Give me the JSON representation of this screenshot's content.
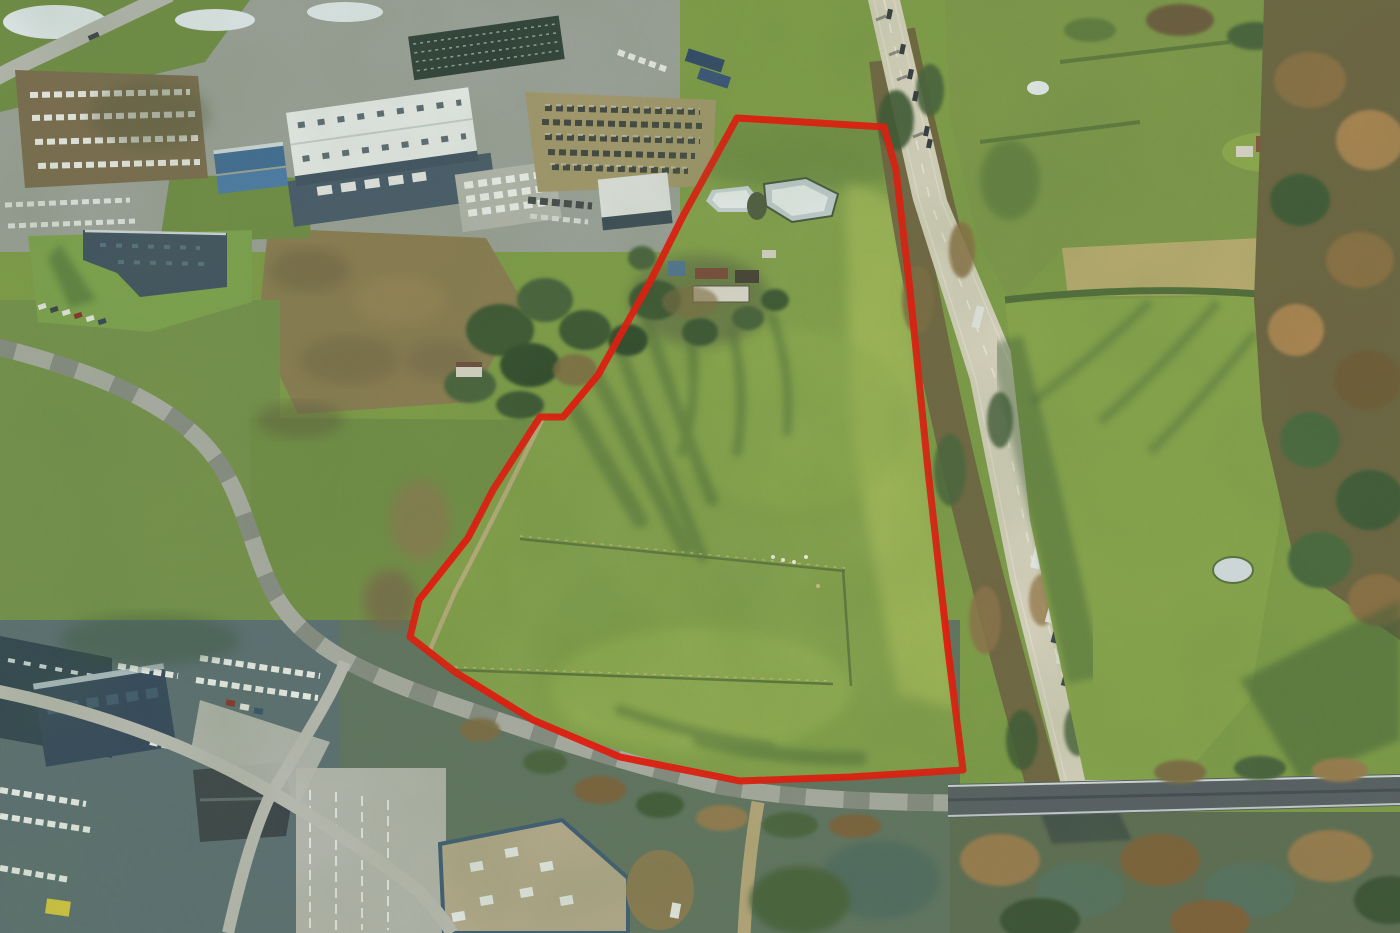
{
  "meta": {
    "type": "aerial-photograph",
    "subject": "winter aerial photo of a development land parcel outlined in red, bounded by a motorway on the east, a local ring road on the south and an industrial estate on the west",
    "contains_text": false
  },
  "annotation": {
    "boundary_color": "#e81408",
    "boundary_stroke_width": 7,
    "boundary_points": "737,118 884,127 896,170 910,290 928,470 948,650 963,770 850,777 740,781 620,757 533,720 455,672 410,637 419,600 468,538 493,490 540,417 563,417 598,375 650,282 683,216"
  },
  "palette": {
    "parcel_grass": "#7e9c46",
    "bright_grass": "#a6bc57",
    "east_field": "#87a44a",
    "motorway": "#d9d3c0",
    "local_road": "#a9aba3",
    "dirt_track": "#b7a67a",
    "scrubland": "#8b7a51",
    "woodland_brown": "#6b6240",
    "tree_green": "#3a5432",
    "roof_white": "#e9eceb",
    "roof_slate": "#3b4d5c",
    "bridge_deck": "#565c64",
    "frozen_water": "#dfe8ee",
    "shadow_green": "#2c4a2b"
  },
  "scene": {
    "elements": [
      "red-boundary-parcel",
      "farmstead-with-frozen-ponds",
      "pasture-fence-lines",
      "motorway-with-vehicles",
      "overpass-bridge",
      "northwest-industrial-estate",
      "machinery-sales-yard",
      "white-logistics-warehouse",
      "southwest-car-dealership",
      "east-pasture-fields",
      "east-woodland-belt",
      "frozen-ponds-north"
    ]
  }
}
